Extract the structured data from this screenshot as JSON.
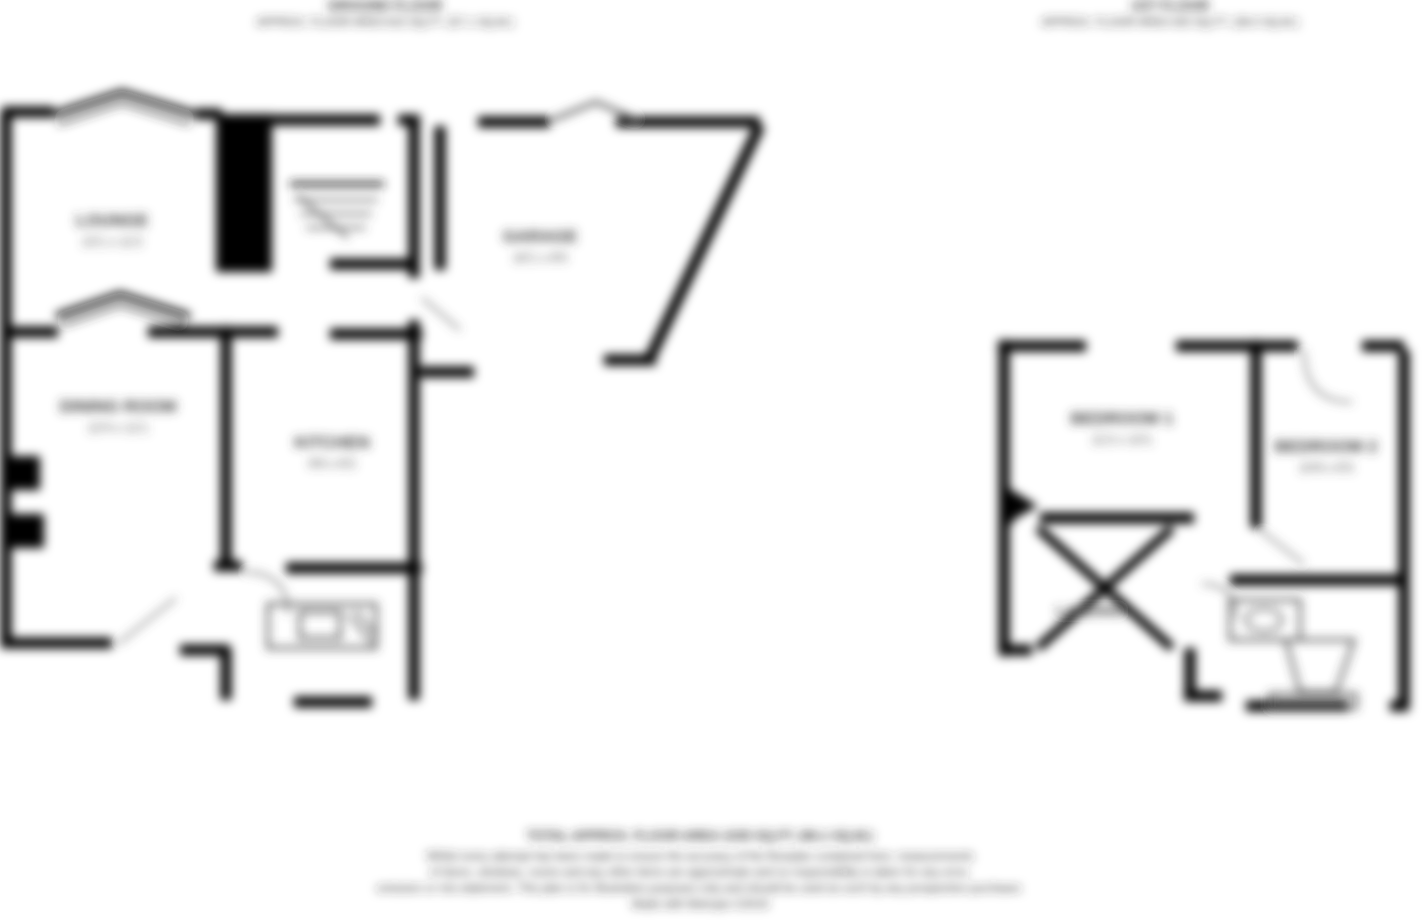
{
  "image": {
    "type": "floorplan",
    "background": "#ffffff",
    "wall_color": "#000000",
    "label_color": "#3a3a3a"
  },
  "ground_floor": {
    "title": "GROUND FLOOR",
    "area": "APPROX. FLOOR AREA 615 SQ.FT. (57.1 SQ.M.)",
    "rooms": {
      "lounge": {
        "name": "LOUNGE",
        "dims": "13'1 x 11'2"
      },
      "dining_room": {
        "name": "DINING ROOM",
        "dims": "12'4 x 11'1"
      },
      "kitchen": {
        "name": "KITCHEN",
        "dims": "9'8 x 8'2"
      },
      "garage": {
        "name": "GARAGE",
        "dims": "16'1 x 8'0"
      }
    }
  },
  "first_floor": {
    "title": "1ST FLOOR",
    "area": "APPROX. FLOOR AREA 420 SQ.FT. (39.0 SQ.M.)",
    "rooms": {
      "bedroom1": {
        "name": "BEDROOM 1",
        "dims": "11'2 x 10'1"
      },
      "bedroom2": {
        "name": "BEDROOM 2",
        "dims": "10'8 x 8'3"
      },
      "landing": {
        "name": "LANDING"
      }
    }
  },
  "footer": {
    "total": "TOTAL APPROX. FLOOR AREA 1035 SQ.FT. (96.1 SQ.M.)",
    "disclaimer_line1": "Whilst every attempt has been made to ensure the accuracy of the floorplan contained here, measurements",
    "disclaimer_line2": "of doors, windows, rooms and any other items are approximate and no responsibility is taken for any error,",
    "disclaimer_line3": "omission or mis-statement. This plan is for illustrative purposes only and should be used as such by any prospective purchaser.",
    "credit": "Made with Metropix ©2019"
  }
}
